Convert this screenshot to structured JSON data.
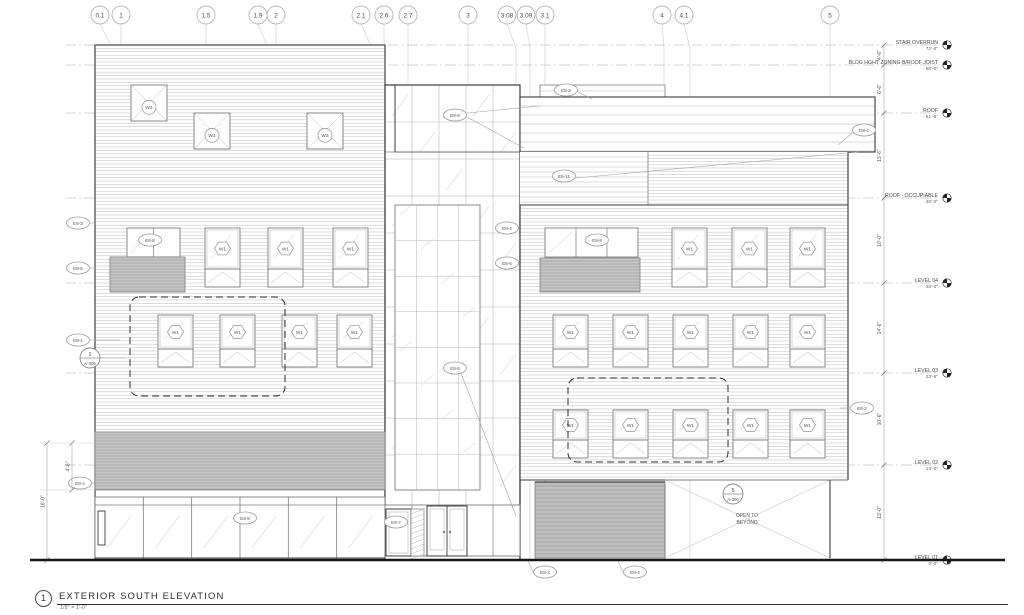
{
  "sheet": {
    "detail_number": "1",
    "title": "EXTERIOR SOUTH ELEVATION",
    "scale": "1/8\" = 1'-0\""
  },
  "colors": {
    "grid_line": "#d2d2d2",
    "level_line": "#a8a8a8",
    "light": "#b4b4b4",
    "med": "#7d7d7d",
    "bold": "#3c3c3c",
    "louver_fill": "#c7c7c7",
    "louver_line": "#8d8d8d",
    "garage_fill": "#bfbfbf",
    "glass_slash": "#dedede",
    "text": "#4a4a4a",
    "tag_stroke": "#9a9a9a",
    "ground": "#161616"
  },
  "grid_bubbles": [
    {
      "label": "0.1",
      "x": 100,
      "gx": 112
    },
    {
      "label": "1",
      "x": 121,
      "gx": 121
    },
    {
      "label": "1.5",
      "x": 206,
      "gx": 206
    },
    {
      "label": "1.9",
      "x": 258,
      "gx": 268
    },
    {
      "label": "2",
      "x": 276,
      "gx": 276
    },
    {
      "label": "2.1",
      "x": 361,
      "gx": 372
    },
    {
      "label": "2.6",
      "x": 384,
      "gx": 384
    },
    {
      "label": "2.7",
      "x": 408,
      "gx": 408
    },
    {
      "label": "3",
      "x": 468,
      "gx": 468
    },
    {
      "label": "3.08",
      "x": 507,
      "gx": 516
    },
    {
      "label": "3.09",
      "x": 526,
      "gx": 530
    },
    {
      "label": "3.1",
      "x": 545,
      "gx": 545
    },
    {
      "label": "4",
      "x": 662,
      "gx": 664
    },
    {
      "label": "4.1",
      "x": 684,
      "gx": 690
    },
    {
      "label": "5",
      "x": 830,
      "gx": 830
    }
  ],
  "levels": [
    {
      "name": "STAIR OVERRUN",
      "elev": "72'-6\"",
      "y": 45
    },
    {
      "name": "BLDG HGHT ZONING B/ROOF JOIST",
      "elev": "68'-0\"",
      "y": 65
    },
    {
      "name": "ROOF",
      "elev": "61'-6\"",
      "y": 113
    },
    {
      "name": "ROOF - OCCUPIABLE",
      "elev": "48'-0\"",
      "y": 198
    },
    {
      "name": "LEVEL 04",
      "elev": "38'-0\"",
      "y": 283
    },
    {
      "name": "LEVEL 03",
      "elev": "23'-6\"",
      "y": 373
    },
    {
      "name": "LEVEL 02",
      "elev": "13'-0\"",
      "y": 465
    },
    {
      "name": "LEVEL 01",
      "elev": "0'-0\"",
      "y": 560
    }
  ],
  "right_dims": [
    {
      "text": "4'-6\"",
      "y1": 45,
      "y2": 65
    },
    {
      "text": "6'-6\"",
      "y1": 65,
      "y2": 113
    },
    {
      "text": "13'-6\"",
      "y1": 113,
      "y2": 198
    },
    {
      "text": "10'-0\"",
      "y1": 198,
      "y2": 283
    },
    {
      "text": "14'-6\"",
      "y1": 283,
      "y2": 373
    },
    {
      "text": "10'-6\"",
      "y1": 373,
      "y2": 465
    },
    {
      "text": "13'-0\"",
      "y1": 465,
      "y2": 560
    }
  ],
  "left_dims": [
    {
      "text": "4'-6\"",
      "x": 72,
      "y1": 443,
      "y2": 490
    },
    {
      "text": "16'-0\"",
      "x": 47,
      "y1": 443,
      "y2": 560
    }
  ],
  "keynotes": [
    {
      "code": "E8-3",
      "x": 566,
      "y": 90,
      "leader": [
        [
          578,
          92
        ],
        [
          592,
          99
        ]
      ]
    },
    {
      "code": "E8-9",
      "x": 455,
      "y": 115
    },
    {
      "code": "E8-11",
      "x": 564,
      "y": 176,
      "leader": [
        [
          576,
          178
        ],
        [
          858,
          152
        ]
      ]
    },
    {
      "code": "E8-3",
      "x": 78,
      "y": 223,
      "leader": [
        [
          90,
          223
        ],
        [
          96,
          223
        ]
      ]
    },
    {
      "code": "E8-8",
      "x": 150,
      "y": 240
    },
    {
      "code": "E8-5",
      "x": 78,
      "y": 268,
      "leader": [
        [
          90,
          268
        ],
        [
          96,
          268
        ]
      ]
    },
    {
      "code": "E8-1",
      "x": 78,
      "y": 340,
      "leader": [
        [
          90,
          340
        ],
        [
          120,
          340
        ]
      ]
    },
    {
      "code": "E8-4",
      "x": 507,
      "y": 228
    },
    {
      "code": "E8-8",
      "x": 597,
      "y": 240
    },
    {
      "code": "E8-5",
      "x": 507,
      "y": 263
    },
    {
      "code": "E8-4",
      "x": 864,
      "y": 130,
      "leader": [
        [
          852,
          133
        ],
        [
          838,
          145
        ]
      ]
    },
    {
      "code": "E8-5",
      "x": 455,
      "y": 368
    },
    {
      "code": "E8-4",
      "x": 80,
      "y": 483,
      "leader": [
        [
          92,
          483
        ],
        [
          96,
          483
        ]
      ]
    },
    {
      "code": "E8-8",
      "x": 245,
      "y": 518
    },
    {
      "code": "E8-7",
      "x": 396,
      "y": 522
    },
    {
      "code": "E8-2",
      "x": 862,
      "y": 408,
      "leader": [
        [
          850,
          408
        ],
        [
          840,
          408
        ]
      ]
    },
    {
      "code": "E8-3",
      "x": 545,
      "y": 572,
      "leader": [
        [
          533,
          572
        ],
        [
          528,
          561
        ]
      ]
    },
    {
      "code": "E8-4",
      "x": 635,
      "y": 572,
      "leader": [
        [
          623,
          572
        ],
        [
          618,
          561
        ]
      ]
    }
  ],
  "callouts": [
    {
      "num": "1",
      "sheet": "A-306",
      "x": 90,
      "y": 358,
      "leader": [
        [
          100,
          358
        ],
        [
          126,
          358
        ]
      ]
    },
    {
      "num": "5",
      "sheet": "A-306",
      "x": 733,
      "y": 494
    }
  ],
  "window_tags": {
    "square": "W3",
    "tall": "W1"
  },
  "windows": {
    "square": {
      "size": 36,
      "items": [
        [
          131,
          85
        ],
        [
          194,
          113
        ],
        [
          307,
          113
        ]
      ]
    },
    "tall_w": 35,
    "tall_rows": [
      {
        "y": 228,
        "h": 59,
        "xs": [
          205,
          268,
          333
        ]
      },
      {
        "y": 228,
        "h": 59,
        "xs": [
          672,
          732,
          790
        ]
      },
      {
        "y": 315,
        "h": 52,
        "xs": [
          158,
          220,
          282,
          337
        ]
      },
      {
        "y": 315,
        "h": 52,
        "xs": [
          553,
          613,
          673,
          733,
          790
        ]
      },
      {
        "y": 410,
        "h": 48,
        "xs": [
          553,
          613,
          673,
          733,
          790
        ]
      }
    ],
    "paired": [
      {
        "x": 127,
        "y": 228,
        "w": 53,
        "h": 29,
        "panes": 2
      },
      {
        "x": 545,
        "y": 228,
        "w": 93,
        "h": 29,
        "panes": 3
      }
    ]
  },
  "louvers": [
    [
      110,
      257,
      75,
      35
    ],
    [
      540,
      258,
      100,
      34
    ],
    [
      95,
      432,
      290,
      58
    ]
  ],
  "garage": [
    535,
    482,
    130,
    76
  ],
  "open_bay": [
    665,
    480,
    165,
    78
  ],
  "dashed_zones": [
    [
      130,
      297,
      155,
      99
    ],
    [
      568,
      378,
      160,
      84
    ]
  ],
  "notes": {
    "open_to_beyond": [
      "OPEN TO",
      "BEYOND"
    ]
  },
  "leaders": [
    [
      [
        467,
        113
      ],
      [
        540,
        106
      ]
    ],
    [
      [
        467,
        117
      ],
      [
        524,
        148
      ]
    ],
    [
      [
        461,
        373
      ],
      [
        516,
        516
      ]
    ]
  ]
}
